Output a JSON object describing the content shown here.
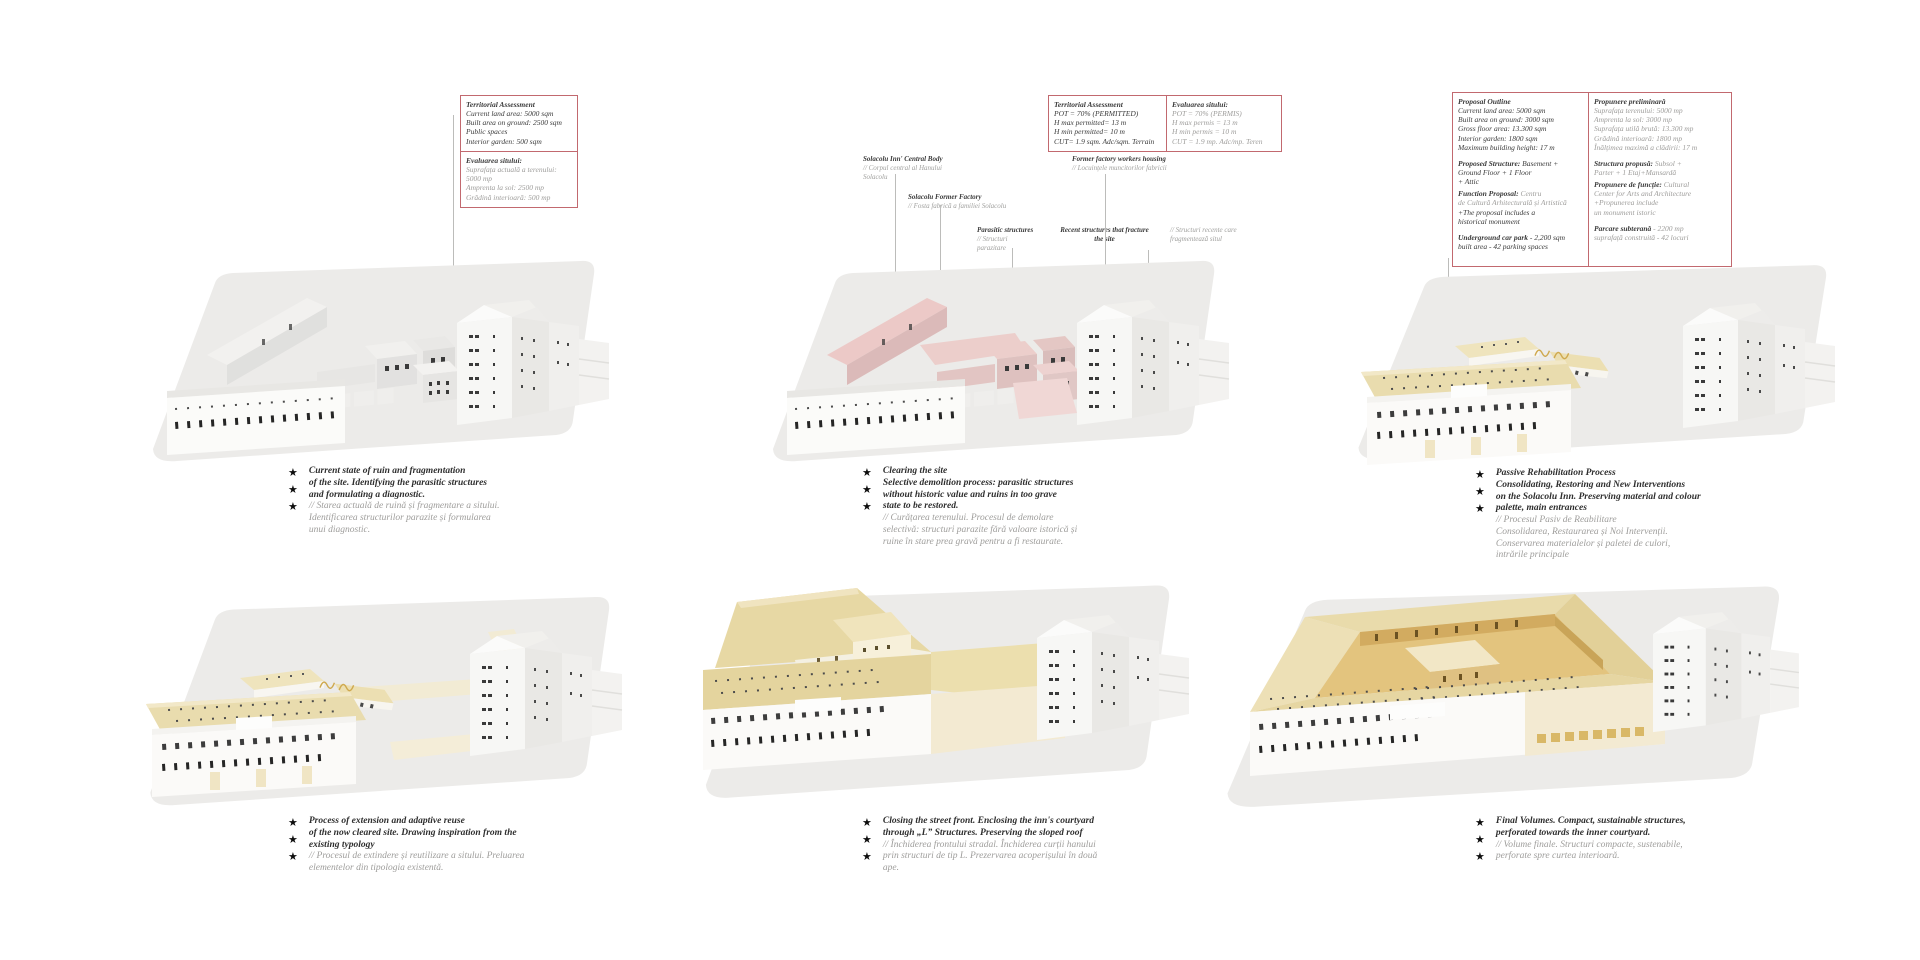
{
  "glyphs": {
    "star": "★"
  },
  "colors": {
    "box_border": "#c2696f",
    "text_dark": "#3b3b3b",
    "text_gray": "#9e9d9b",
    "highlight_pink": "#ecc9c7",
    "cream_roof": "#e9dcae",
    "gold_courtyard": "#e3c47e",
    "plate_gray": "#ecebe9"
  },
  "panels": [
    {
      "boxes": [
        {
          "title": "Territorial Assessment",
          "body": "Current land area: 5000 sqm\nBuilt area on ground: 2500 sqm\nPublic spaces\nInterior garden: 500 sqm"
        },
        {
          "title": "Evaluarea sitului:",
          "body": "Suprafața actuală a terenului:\n5000 mp\nAmprenta la sol: 2500 mp\nGrădină interioară: 500 mp"
        }
      ],
      "caption": {
        "en": "Current state of ruin and fragmentation\nof the site. Identifying the parasitic structures\nand formulating a diagnostic.",
        "ro": "// Starea actuală de ruină și fragmentare a sitului.\nIdentificarea structurilor parazite și formularea\nunui diagnostic."
      }
    },
    {
      "boxes": [
        {
          "title": "Territorial Assessment",
          "body": "POT = 70% (PERMITTED)\nH max permitted= 13 m\nH min permitted= 10 m\nCUT= 1.9 sqm. Adc/sqm. Terrain"
        },
        {
          "title": "Evaluarea sitului:",
          "body": "POT = 70% (PERMIS)\nH max permis = 13 m\nH min permis = 10 m\nCUT = 1.9 mp. Adc/mp. Teren"
        }
      ],
      "callouts": [
        {
          "en": "Solacolu Inn' Central Body",
          "ro": "// Corpul central al Hanului\nSolacolu"
        },
        {
          "en": "Solacolu Former Factory",
          "ro": "// Fosta fabrică a familiei Solacolu"
        },
        {
          "en": "Parasitic structures",
          "ro": "// Structuri\nparazitare"
        },
        {
          "en": "Former factory workers housing",
          "ro": "// Locuințele muncitorilor fabricii"
        },
        {
          "en": "Recent structures that fracture\nthe site",
          "ro": "// Structuri recente care\nfragmentează situl"
        }
      ],
      "caption": {
        "en": "Clearing the site\nSelective demolition process: parasitic structures\nwithout historic value and ruins in too grave\nstate to be restored.",
        "ro": "// Curățarea terenului. Procesul de demolare\nselectivă: structuri parazite fără valoare istorică și\nruine în stare prea gravă pentru a fi restaurate."
      }
    },
    {
      "boxes": [
        {
          "title": "Proposal Outline",
          "b1": "Current land area: 5000 sqm\nBuilt area on ground: 3000 sqm\nGross floor area: 13.300 sqm\nInterior garden: 1800 sqm\nMaximum building height: 17 m",
          "b2_lead": "Proposed Structure:",
          "b2_rest": " Basement +\nGround Floor + 1 Floor\n+ Attic",
          "b3_lead": "Function Proposal:",
          "b3_mid": " Centru\nde Cultură Arhitecturală și Artistică",
          "b3_tail": "+The proposal includes a\nhistorical monument",
          "b4_lead": "Underground car park",
          "b4_rest": " - 2,200 sqm\nbuilt area - 42 parking spaces"
        },
        {
          "title": "Propunere preliminară",
          "b1": "Suprafața terenului: 5000 mp\nAmprenta la sol: 3000 mp\nSuprafața utilă brută: 13.300 mp\nGrădină interioară: 1800 mp\nÎnălțimea maximă a clădirii: 17 m",
          "b2_lead": "Structura propusă:",
          "b2_rest": " Subsol +\nParter + 1 Etaj+Mansardă",
          "b3_lead": "Propunere de funcție:",
          "b3_mid": " Cultural\nCenter for Arts and Architecture",
          "b3_tail": "+Propunerea include\nun monument istoric",
          "b4_lead": "Parcare subterană",
          "b4_rest": " - 2200 mp\nsuprafață construită - 42 locuri"
        }
      ],
      "caption": {
        "en": "Passive Rehabilitation Process\nConsolidating, Restoring and New Interventions\non the Solacolu Inn. Preserving material and colour\npalette, main entrances",
        "ro": "// Procesul Pasiv de Reabilitare\nConsolidarea, Restaurarea și Noi Intervenții.\nConservarea materialelor și paletei de culori,\nintrările principale"
      }
    },
    {
      "caption": {
        "en": "Process of extension and adaptive reuse\nof the now cleared site. Drawing inspiration from the\nexisting typology",
        "ro": "// Procesul de extindere și reutilizare a sitului. Preluarea\nelementelor din tipologia existentă."
      }
    },
    {
      "caption": {
        "en": "Closing the street front. Enclosing the inn's courtyard\nthrough „L” Structures. Preserving the sloped roof",
        "ro": "// Închiderea frontului stradal. Închiderea curții hanului\nprin structuri de tip L. Prezervarea acoperișului în două\nape."
      }
    },
    {
      "caption": {
        "en": "Final Volumes. Compact, sustainable structures,\nperforated towards the inner courtyard.",
        "ro": "// Volume finale. Structuri compacte, sustenabile,\nperforate spre curtea interioară."
      }
    }
  ]
}
